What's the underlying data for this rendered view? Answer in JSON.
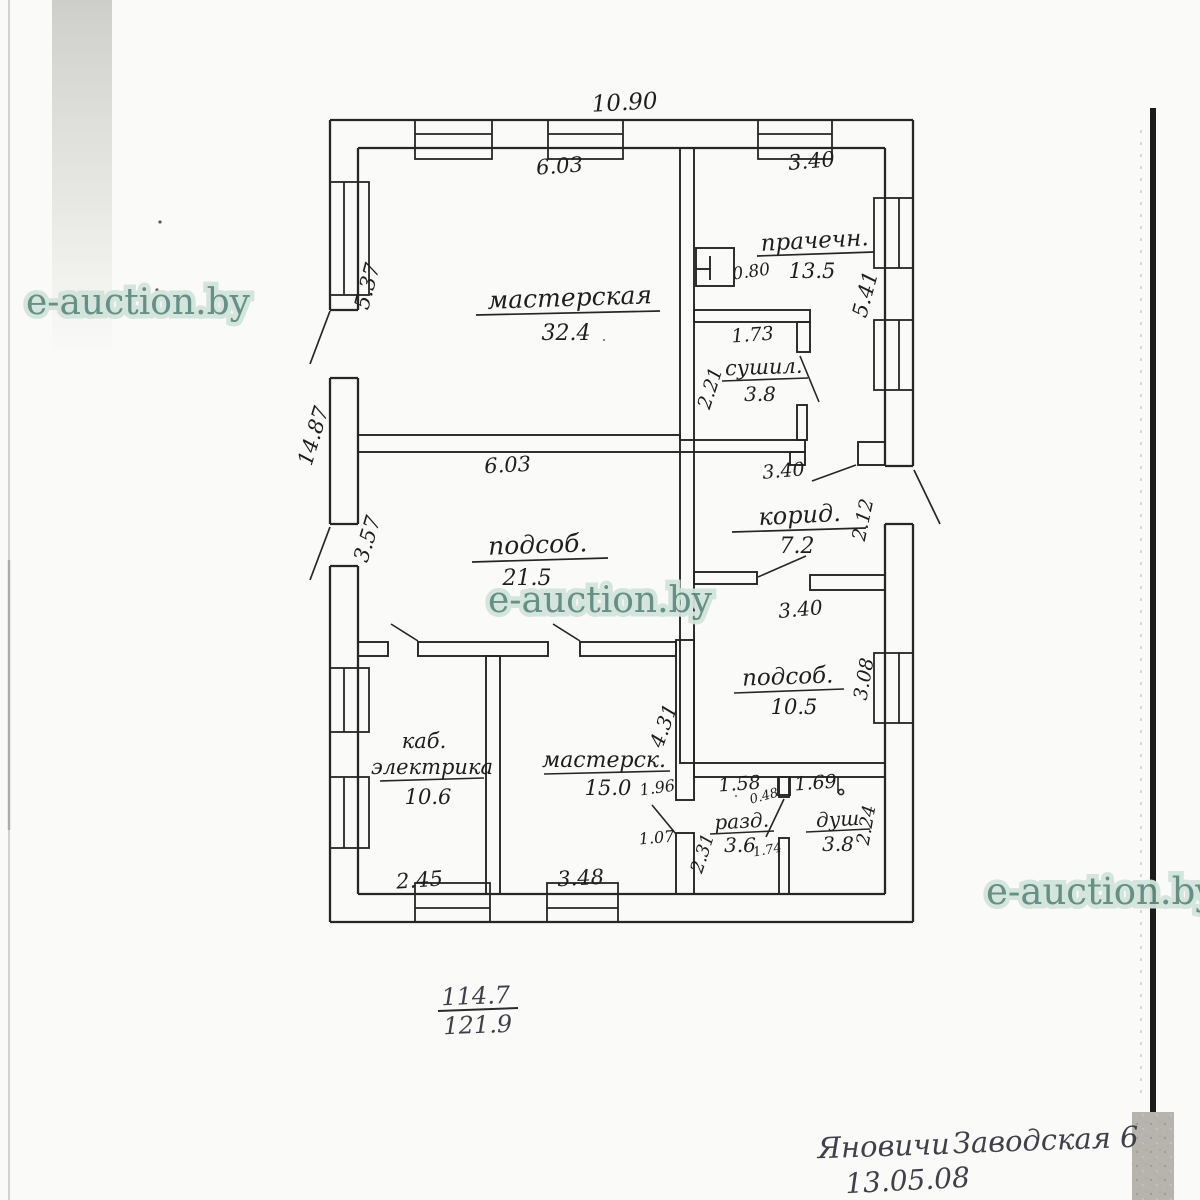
{
  "watermark": {
    "text": "e-auction.by"
  },
  "plan": {
    "rooms": [
      {
        "name": "мастерская",
        "area": "32.4"
      },
      {
        "name": "прачечн.",
        "area": "13.5"
      },
      {
        "name": "сушил.",
        "area": "3.8"
      },
      {
        "name": "подсоб.",
        "area": "21.5"
      },
      {
        "name": "корид.",
        "area": "7.2"
      },
      {
        "name": "подсоб.",
        "area": "10.5"
      },
      {
        "name": "каб.",
        "name2": "электрика",
        "area": "10.6"
      },
      {
        "name": "мастерск.",
        "area": "15.0"
      },
      {
        "name": "разд.",
        "area": "3.6"
      },
      {
        "name": "душ",
        "area": "3.8"
      }
    ],
    "dims": {
      "top_overall": "10.90",
      "workshop_w": "6.03",
      "laundry_w": "3.40",
      "left_upper": "5.37",
      "right_upper": "5.41",
      "closet_w": "0.80",
      "dryer_w": "1.73",
      "dryer_h": "2.21",
      "left_total": "14.87",
      "left_lower": "3.57",
      "utility1_w": "6.03",
      "corridor_w": "3.40",
      "corridor_door": "2.12",
      "utility2_w": "3.40",
      "utility2_h": "3.08",
      "workshop2_h": "4.31",
      "door_196": "1.96",
      "door_107": "1.07",
      "passage_h": "2.31",
      "locker_w1": "1.58",
      "locker_w2": "0.48",
      "shower_w": "1.69",
      "locker_d": "1.74",
      "shower_h": "2.24",
      "elec_w": "2.45",
      "workshop2_w": "3.48"
    },
    "totals": {
      "upper": "114.7",
      "lower": "121.9"
    }
  },
  "handwriting": {
    "line1_word1": "Яновичи",
    "line1_word2": "Заводская 6",
    "line2": "13.05.08"
  }
}
